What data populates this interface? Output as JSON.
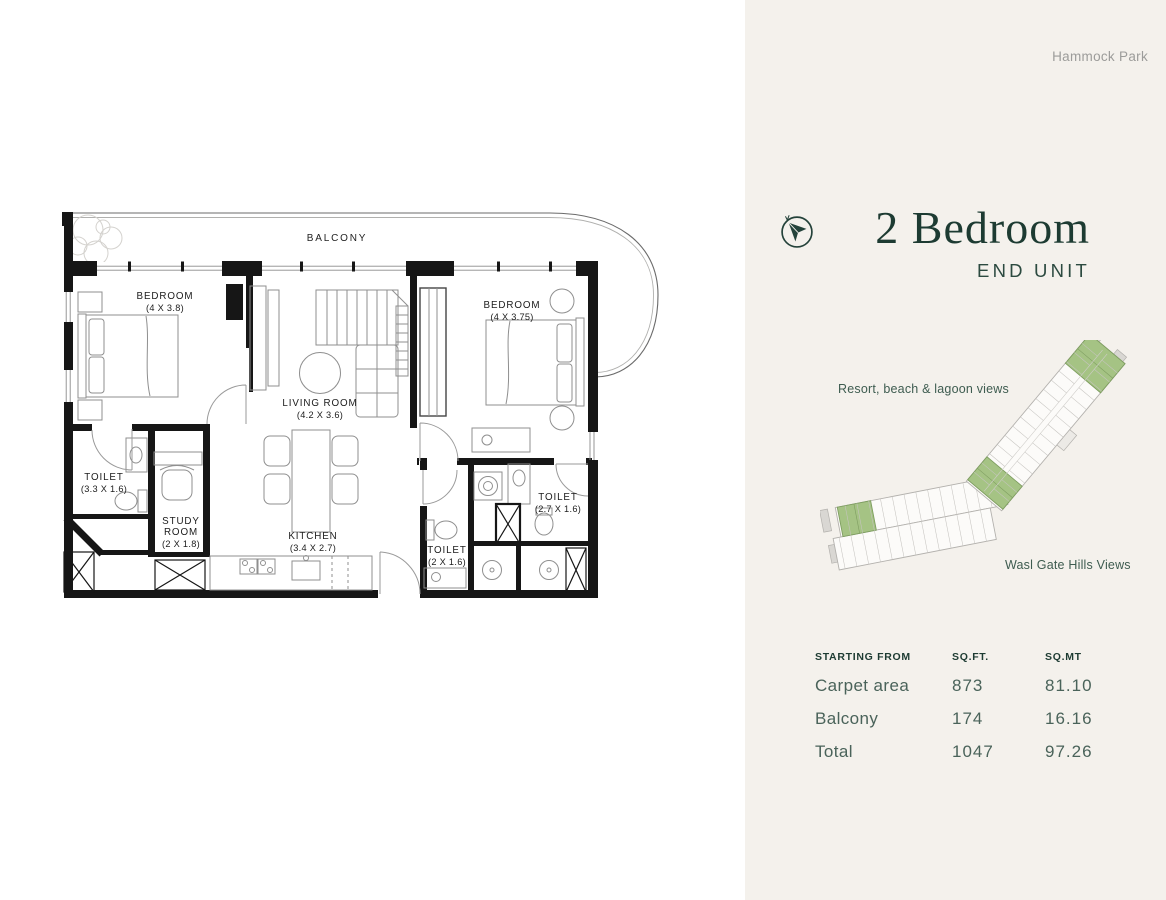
{
  "header": {
    "brand": "Hammock Park"
  },
  "unit": {
    "title": "2 Bedroom",
    "subtitle": "END UNIT"
  },
  "site_map": {
    "view_top": "Resort, beach & lagoon views",
    "view_bottom": "Wasl Gate Hills Views",
    "highlight_color": "#a5c384"
  },
  "area_table": {
    "headers": [
      "STARTING FROM",
      "SQ.FT.",
      "SQ.MT"
    ],
    "rows": [
      {
        "label": "Carpet area",
        "sqft": "873",
        "sqmt": "81.10"
      },
      {
        "label": "Balcony",
        "sqft": "174",
        "sqmt": "16.16"
      },
      {
        "label": "Total",
        "sqft": "1047",
        "sqmt": "97.26"
      }
    ]
  },
  "floor_plan": {
    "compass_icon": "north-arrow-compass",
    "rooms": [
      {
        "name": "BALCONY",
        "dims": ""
      },
      {
        "name": "BEDROOM",
        "dims": "(4 X 3.8)"
      },
      {
        "name": "BEDROOM",
        "dims": "(4 X 3.75)"
      },
      {
        "name": "LIVING ROOM",
        "dims": "(4.2 X 3.6)"
      },
      {
        "name": "TOILET",
        "dims": "(3.3 X 1.6)"
      },
      {
        "name": "STUDY ROOM",
        "name_lines": [
          "STUDY",
          "ROOM"
        ],
        "dims": "(2 X 1.8)"
      },
      {
        "name": "KITCHEN",
        "dims": "(3.4 X 2.7)"
      },
      {
        "name": "TOILET",
        "dims": "(2.7 X 1.6)"
      },
      {
        "name": "TOILET",
        "dims": "(2 X 1.6)"
      }
    ]
  },
  "colors": {
    "panel_bg": "#f4f1ec",
    "title": "#1d3b32",
    "subtitle": "#2c4a40",
    "brand": "#9c9c9a",
    "view_label": "#3e5c50",
    "table_header": "#1d3b32",
    "table_body": "#4a635a",
    "highlight_green": "#a5c384",
    "plan_ink": "#161616"
  }
}
